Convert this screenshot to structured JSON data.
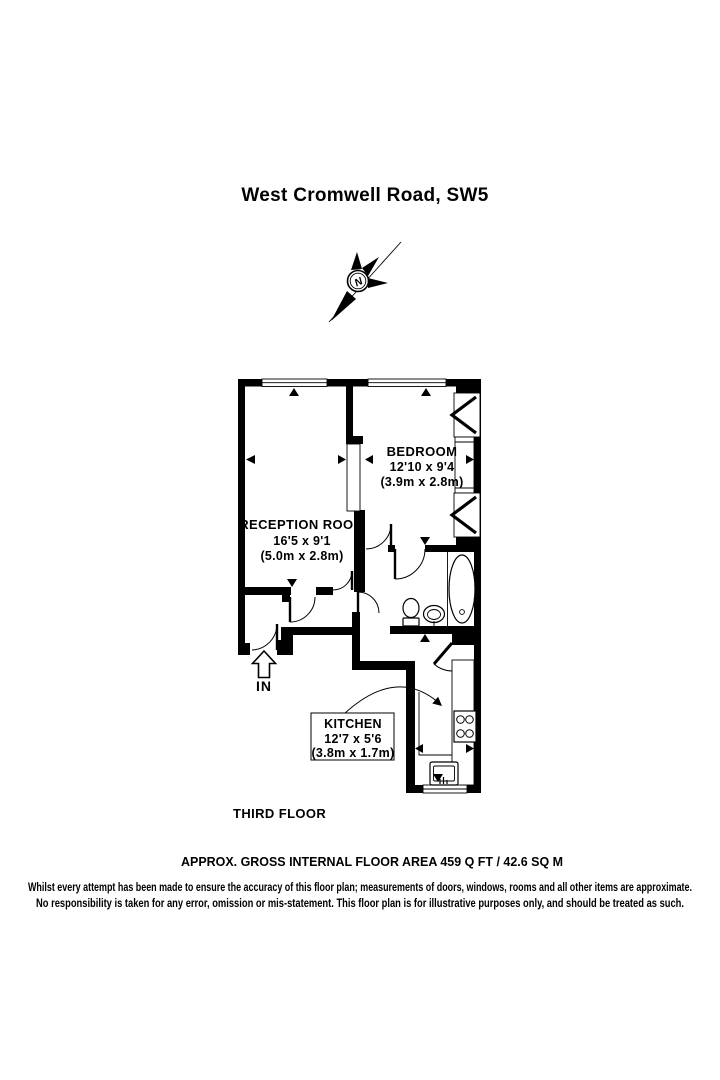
{
  "title": "West Cromwell Road, SW5",
  "compass": {
    "north_label": "N"
  },
  "rooms": {
    "reception": {
      "name": "RECEPTION ROOM",
      "dimensions_imperial": "16'5 x 9'1",
      "dimensions_metric": "(5.0m x 2.8m)"
    },
    "bedroom": {
      "name": "BEDROOM",
      "dimensions_imperial": "12'10 x 9'4",
      "dimensions_metric": "(3.9m x 2.8m)"
    },
    "kitchen": {
      "name": "KITCHEN",
      "dimensions_imperial": "12'7 x 5'6",
      "dimensions_metric": "(3.8m x 1.7m)"
    }
  },
  "entrance": {
    "label": "IN"
  },
  "floor_label": "THIRD FLOOR",
  "area_summary": "APPROX. GROSS INTERNAL FLOOR AREA 459 Q FT / 42.6 SQ M",
  "disclaimer": {
    "line1": "Whilst every attempt has been made to ensure the accuracy of this floor plan; measurements of doors, windows, rooms and all other items are approximate.",
    "line2": "No responsibility is taken for any error, omission or mis-statement.  This floor plan is for illustrative purposes only, and should be treated as such."
  },
  "colors": {
    "wall": "#000000",
    "background": "#ffffff"
  }
}
